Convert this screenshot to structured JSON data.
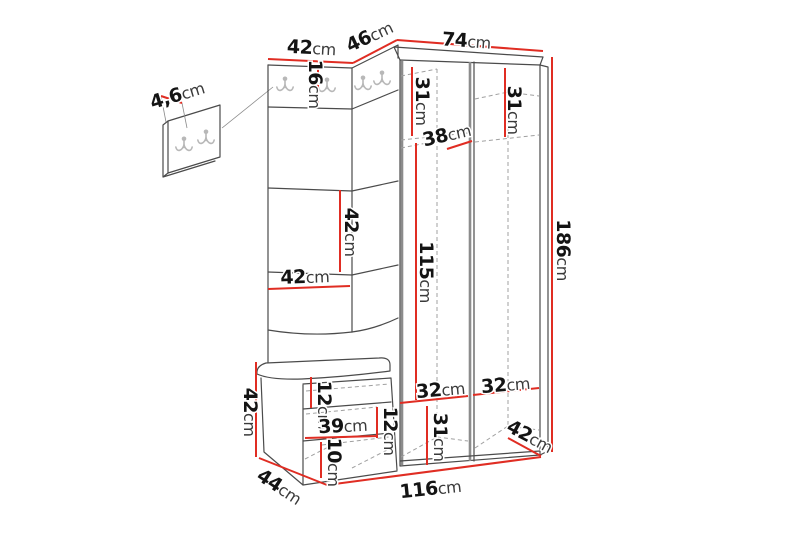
{
  "diagram": {
    "kind": "furniture-dimension-diagram",
    "unit": "cm",
    "colors": {
      "background": "#ffffff",
      "dimension_red": "#e02d23",
      "outline": "#4b4b4b",
      "dashed": "#a0a0a0",
      "hook": "#b8b8b8",
      "label_number": "#141414",
      "label_unit": "#3a3a3a"
    },
    "icons": {
      "coat_hook": "double-prong-coat-hook"
    }
  },
  "labels": {
    "wall_panel_thickness": {
      "value": "4,6",
      "unit": "cm"
    },
    "left_section_width": {
      "value": "42",
      "unit": "cm"
    },
    "corner_section_width": {
      "value": "46",
      "unit": "cm"
    },
    "wardrobe_width": {
      "value": "74",
      "unit": "cm"
    },
    "hook_board_height": {
      "value": "16",
      "unit": "cm"
    },
    "top_compartment_left_height": {
      "value": "31",
      "unit": "cm"
    },
    "top_compartment_right_height": {
      "value": "31",
      "unit": "cm"
    },
    "interior_shelf_width": {
      "value": "38",
      "unit": "cm"
    },
    "panel_height": {
      "value": "42",
      "unit": "cm"
    },
    "panel_width": {
      "value": "42",
      "unit": "cm"
    },
    "hanging_space_height": {
      "value": "115",
      "unit": "cm"
    },
    "total_height": {
      "value": "186",
      "unit": "cm"
    },
    "bench_height": {
      "value": "42",
      "unit": "cm"
    },
    "seat_to_shelf_gap": {
      "value": "12",
      "unit": "cm"
    },
    "bench_interior_width": {
      "value": "39",
      "unit": "cm"
    },
    "bench_shelf_gap": {
      "value": "12",
      "unit": "cm"
    },
    "bench_bottom_height": {
      "value": "10",
      "unit": "cm"
    },
    "bottom_shelf_left_width": {
      "value": "32",
      "unit": "cm"
    },
    "bottom_shelf_right_width": {
      "value": "32",
      "unit": "cm"
    },
    "bottom_compartment_height": {
      "value": "31",
      "unit": "cm"
    },
    "wardrobe_depth": {
      "value": "42",
      "unit": "cm"
    },
    "bench_depth": {
      "value": "44",
      "unit": "cm"
    },
    "total_width": {
      "value": "116",
      "unit": "cm"
    }
  }
}
